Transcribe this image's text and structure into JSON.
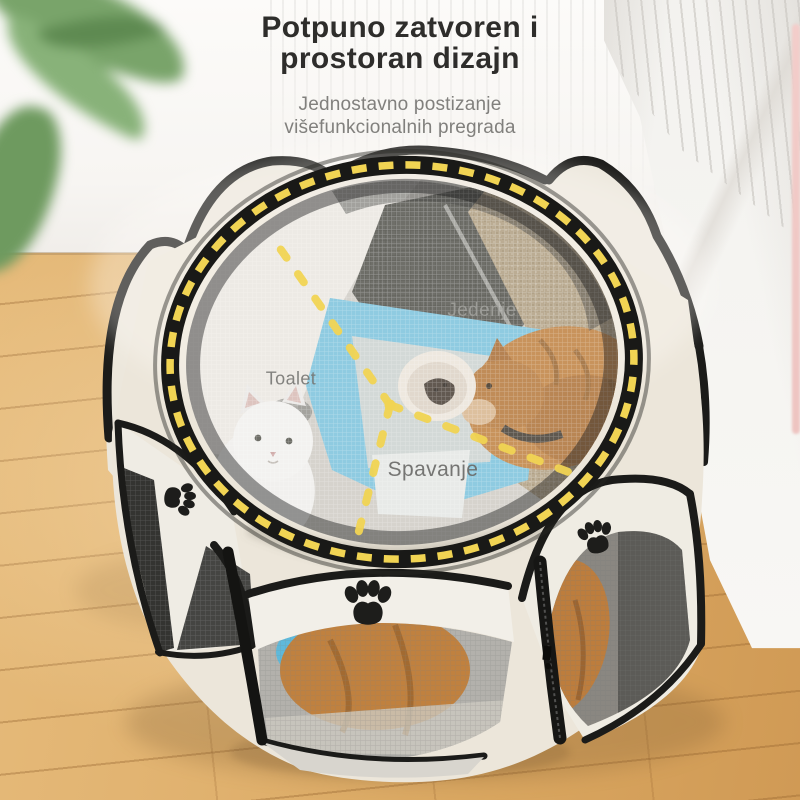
{
  "header": {
    "title_line1": "Potpuno zatvoren i",
    "title_line2": "prostoran dizajn",
    "subtitle_line1": "Jednostavno postizanje",
    "subtitle_line2": "višefunkcionalnih pregrada"
  },
  "playpen": {
    "zone_labels": {
      "eating": "Jedenje",
      "toilet": "Toalet",
      "sleeping": "Spavanje"
    },
    "icons": {
      "paw": "paw-print-icon"
    },
    "colors": {
      "dash_accent_yellow": "#F1D453",
      "fabric_cream": "#ECE7DC",
      "trim_black": "#1B1B19",
      "mat_blue": "#7CC2DC",
      "cat_orange": "#BF8040",
      "cat_white": "#F0EFED",
      "mesh_gray": "#8A8781",
      "floor_wood": "#DCAB64"
    }
  }
}
